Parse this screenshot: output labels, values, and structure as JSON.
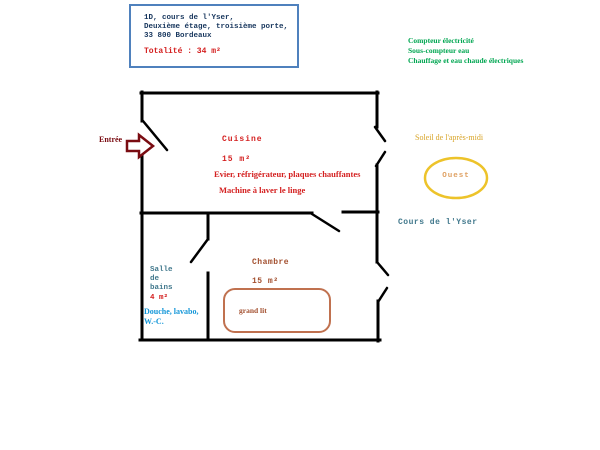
{
  "colors": {
    "wall": "#000000",
    "box_border": "#4f81bd",
    "navy": "#17365d",
    "red": "#d42020",
    "green": "#00a651",
    "maroon": "#7a0c12",
    "gold": "#edc32a",
    "goldenrod": "#d8a428",
    "peach": "#dfa061",
    "teal": "#41788c",
    "blue": "#1296d8",
    "brown": "#a24e2d",
    "bed": "#c0714f"
  },
  "info_box": {
    "line1": "1D, cours de l'Yser,",
    "line2": "Deuxième étage, troisième porte,",
    "line3": "33 800 Bordeaux",
    "total": "Totalité : 34 m²"
  },
  "utilities": {
    "line1": "Compteur électricité",
    "line2": "Sous-compteur eau",
    "line3": "Chauffage et eau chaude électriques"
  },
  "entrance": {
    "label": "Entrée"
  },
  "rooms": {
    "cuisine": {
      "name": "Cuisine",
      "area": "15 m²",
      "equipment1": "Evier, réfrigérateur, plaques chauffantes",
      "equipment2": "Machine à laver le linge"
    },
    "salle_de_bains": {
      "name": "Salle\nde\nbains",
      "area": "4 m²",
      "equipment": "Douche, lavabo,\nW.-C."
    },
    "chambre": {
      "name": "Chambre",
      "area": "15 m²",
      "furniture": "grand lit"
    }
  },
  "exterior": {
    "sun": "Soleil de l'après-midi",
    "orientation": "Ouest",
    "street": "Cours de l'Yser"
  }
}
